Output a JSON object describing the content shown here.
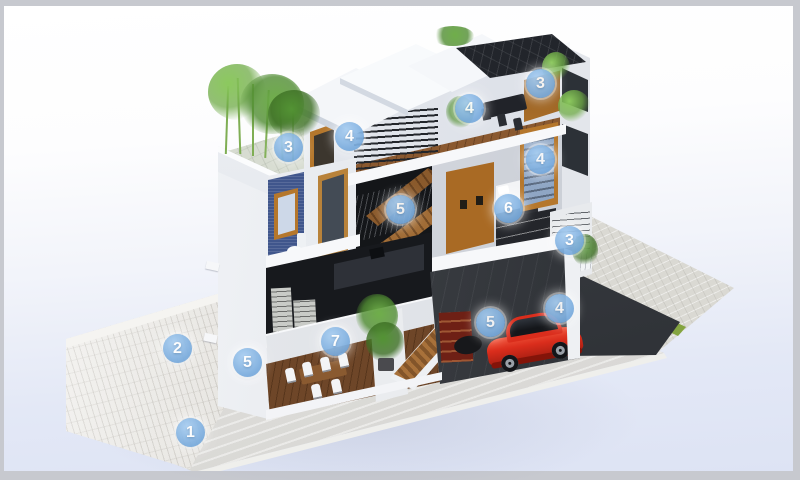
{
  "figure": {
    "type": "architectural-cutaway-illustration",
    "subject": "Three-story house cross-section with numbered callout markers",
    "callouts": [
      {
        "label": "1",
        "x": 187,
        "y": 427
      },
      {
        "label": "2",
        "x": 174,
        "y": 343
      },
      {
        "label": "3",
        "x": 285,
        "y": 142
      },
      {
        "label": "4",
        "x": 346,
        "y": 131
      },
      {
        "label": "4",
        "x": 466,
        "y": 103
      },
      {
        "label": "3",
        "x": 537,
        "y": 78
      },
      {
        "label": "4",
        "x": 537,
        "y": 154
      },
      {
        "label": "5",
        "x": 397,
        "y": 204
      },
      {
        "label": "6",
        "x": 505,
        "y": 203
      },
      {
        "label": "3",
        "x": 566,
        "y": 235
      },
      {
        "label": "5",
        "x": 487,
        "y": 317
      },
      {
        "label": "4",
        "x": 556,
        "y": 303
      },
      {
        "label": "5",
        "x": 244,
        "y": 357
      },
      {
        "label": "7",
        "x": 332,
        "y": 336
      }
    ],
    "colors": {
      "badge_fill": "#79abdd",
      "badge_text": "#ffffff",
      "background_top": "#ffffff",
      "background_bottom": "#dde3f4",
      "frame_border": "#c7c9cf",
      "house_wall": "#eef0f4",
      "solar_roof": "#22252b",
      "car": "#da2d1c",
      "foliage": "#66a445",
      "wood_trim": "#b5772c",
      "stone_wall": "#eae8e3",
      "lawn_strip": "#84a440",
      "driveway": "#43464b",
      "pavement": "#dad9d3",
      "concrete": "#dfdedc"
    }
  }
}
